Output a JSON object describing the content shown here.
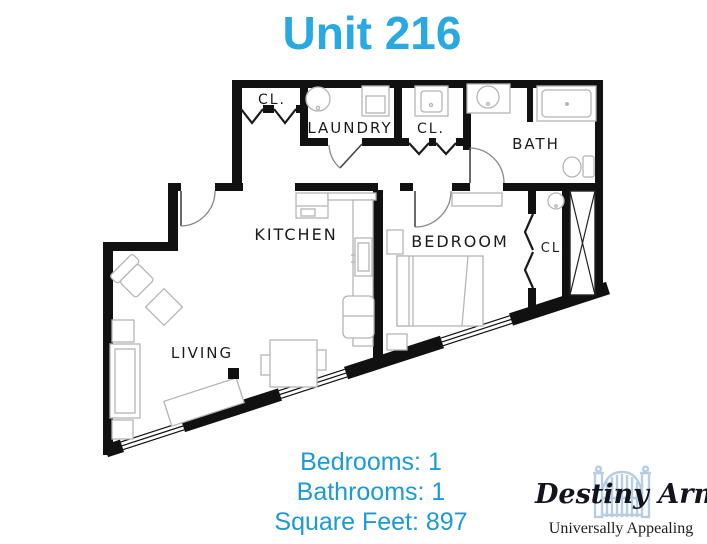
{
  "title": "Unit 216",
  "accent_color": "#29a9e1",
  "info_color": "#1c9ad4",
  "floorplan": {
    "labels": {
      "closet_top": "CL.",
      "laundry": "LAUNDRY",
      "closet_mid": "CL.",
      "bath": "BATH",
      "kitchen": "KITCHEN",
      "bedroom": "BEDROOM",
      "closet_bedroom": "CL.",
      "living": "LIVING"
    }
  },
  "info": {
    "bedrooms": "Bedrooms: 1",
    "bathrooms": "Bathrooms: 1",
    "square_feet": "Square Feet: 897"
  },
  "logo": {
    "name": "Destiny Arms",
    "tagline": "Universally Appealing",
    "gate_color": "#b6cde2"
  }
}
